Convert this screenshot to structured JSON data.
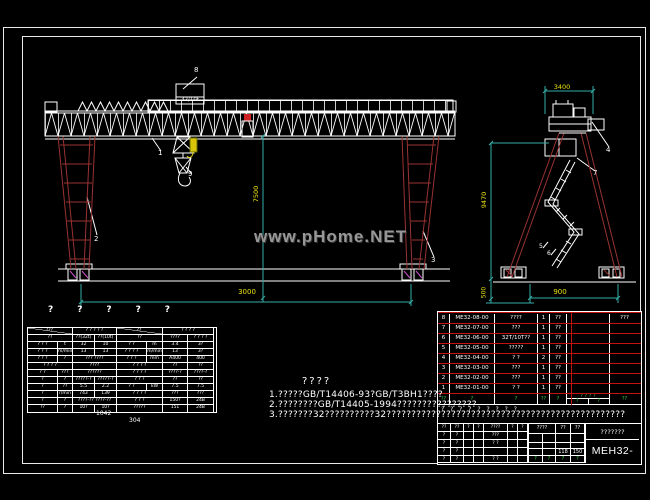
{
  "labels": {
    "trolley": "32/10t",
    "watermark": "www.pHome.NET"
  },
  "callouts": {
    "c1": "1",
    "c2": "2",
    "c3": "3",
    "c4": "4",
    "c5": "5",
    "c6": "6",
    "c7": "7",
    "c8": "8",
    "c9": "9"
  },
  "dims": {
    "span": "3000",
    "height": "7500",
    "top_width": "3400",
    "side_height": "9470",
    "base_width": "900",
    "buffer": "500",
    "n1": "1042",
    "n2": "304"
  },
  "qmarks": [
    "?",
    "?",
    "?",
    "?",
    "?"
  ],
  "notes": {
    "title": "????",
    "l1": "1.?????GB/T14406-93?GB/T3BH1????",
    "l2": "2.????????GB/T14405-1994????????????????",
    "l3": "3.???????32??????????32????????????????????????????????????????????????"
  },
  "spec": {
    "r0": [
      "???",
      "? ? ? ? ?",
      "??",
      "?  ?  ?  ?"
    ],
    "r1": [
      "??",
      "??(32t)",
      "??(10t)",
      "??",
      "????",
      "? ? ? ?"
    ],
    "r2": [
      "? ? ?",
      "t",
      "32",
      "10",
      "?  ?",
      "m",
      "3.4",
      "3?"
    ],
    "r3": [
      "? ? ?",
      "m/min",
      "13",
      "13",
      "? ? ? ?",
      "m/min",
      "13",
      "3?"
    ],
    "r4": [
      "? ? ?",
      "?",
      "???  ????",
      "? ? ?",
      "mm",
      "A400",
      "400"
    ],
    "r5": [
      "? ? ? ?",
      "????",
      "?  ?  ?  ?",
      "??",
      "??"
    ],
    "r6": [
      "?  ?",
      "???",
      "??????",
      "? ? ? ?",
      "????-?",
      "????-?"
    ],
    "r7": [
      "?",
      "?",
      "?????-?",
      "?????-?",
      "?  ?  ?",
      "??",
      "??"
    ],
    "r8": [
      "?",
      "??",
      "5.5",
      "2.2",
      "?  ?",
      "kW",
      "7.5",
      "7.5"
    ],
    "r9": [
      "?",
      "r/min",
      "743",
      "139",
      "? ? ? ?",
      "???",
      "???"
    ],
    "r10": [
      "?",
      "?",
      "????-??  ????-??",
      "? ? ?",
      "150?",
      "24B"
    ],
    "r11": [
      "??",
      "?",
      "10?",
      "10?",
      "?????",
      "151",
      "24B"
    ]
  },
  "bom": {
    "rows": [
      {
        "no": "8",
        "code": "ME32-08-00",
        "name": "????",
        "qty": "1",
        "mat": "??",
        "x": "",
        "note": "???"
      },
      {
        "no": "7",
        "code": "ME32-07-00",
        "name": "???",
        "qty": "1",
        "mat": "??",
        "x": "",
        "note": ""
      },
      {
        "no": "6",
        "code": "ME32-06-00",
        "name": "32T/10T??",
        "qty": "1",
        "mat": "??",
        "x": "",
        "note": ""
      },
      {
        "no": "5",
        "code": "ME32-05-00",
        "name": "?????",
        "qty": "1",
        "mat": "??",
        "x": "",
        "note": ""
      },
      {
        "no": "4",
        "code": "ME32-04-00",
        "name": "? ?",
        "qty": "2",
        "mat": "??",
        "x": "",
        "note": ""
      },
      {
        "no": "3",
        "code": "ME32-03-00",
        "name": "???",
        "qty": "1",
        "mat": "??",
        "x": "",
        "note": ""
      },
      {
        "no": "2",
        "code": "ME32-02-00",
        "name": "???",
        "qty": "1",
        "mat": "??",
        "x": "",
        "note": ""
      },
      {
        "no": "1",
        "code": "ME32-01-00",
        "name": "? ?",
        "qty": "1",
        "mat": "??",
        "x": "",
        "note": ""
      }
    ],
    "header": {
      "no": "??",
      "code": "?",
      "name": "?",
      "qty": "??",
      "mat": "?",
      "w_top": "? ? ? ?",
      "w_b1": "?",
      "w_b2": "?",
      "note": "??"
    }
  },
  "tb": {
    "toptext": "? ? ? ? ? ? ? ? ?",
    "h": [
      "??",
      "??",
      "?",
      "?",
      "????",
      "?",
      "?"
    ],
    "l1": [
      "?",
      "?",
      "",
      "",
      "???",
      "",
      ""
    ],
    "l2": [
      "?",
      "?",
      "",
      "",
      "? ?",
      "",
      ""
    ],
    "l3": [
      "?",
      "?",
      "",
      "",
      "",
      "",
      ""
    ],
    "l4": [
      "?",
      "?",
      "",
      "",
      "? ?",
      "",
      ""
    ],
    "m_h": [
      "????",
      "??",
      "??"
    ],
    "m_r2": [
      "",
      "",
      "",
      ""
    ],
    "m_r3": [
      "",
      "",
      "118",
      "150"
    ],
    "m_g": [
      "?",
      "?",
      "?",
      "?"
    ],
    "right_name": "???????",
    "right_code": "MEH32-00"
  }
}
